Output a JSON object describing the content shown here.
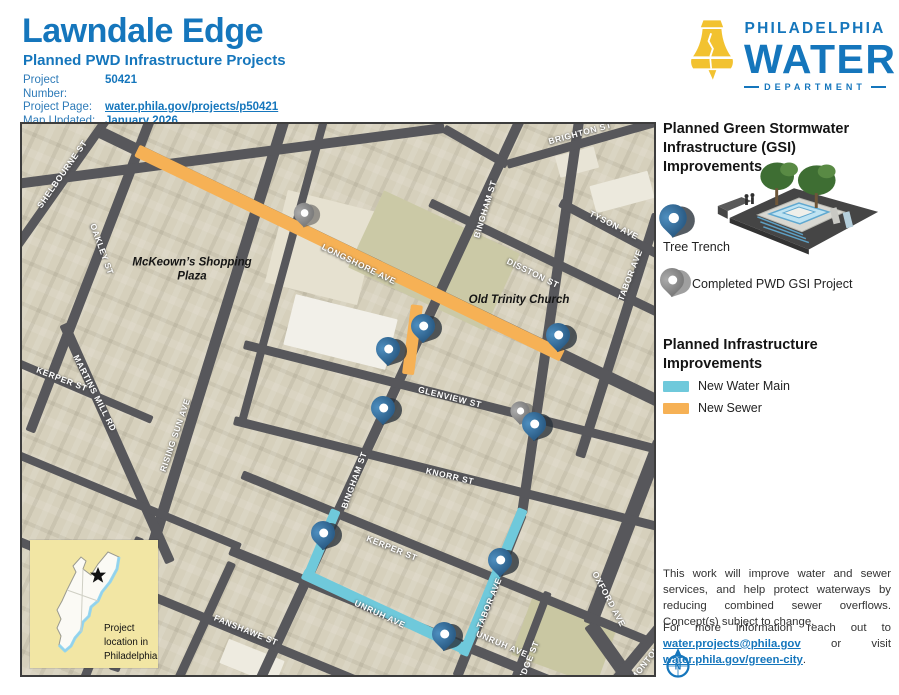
{
  "header": {
    "title": "Lawndale Edge",
    "subtitle": "Planned PWD Infrastructure Projects",
    "meta": [
      {
        "label": "Project Number:",
        "value": "50421"
      },
      {
        "label": "Project Page:",
        "value": "water.phila.gov/projects/p50421"
      },
      {
        "label": "Map Updated:",
        "value": "January 2026"
      }
    ]
  },
  "logo": {
    "line1": "PHILADELPHIA",
    "line2": "WATER",
    "line3": "DEPARTMENT"
  },
  "colors": {
    "brand_blue": "#1576BC",
    "bell_yellow": "#F2C230",
    "sewer_orange": "#F6B155",
    "water_cyan": "#6FC9DB",
    "road_gray": "#57575B",
    "pin_blue": "#2F6590",
    "pin_gray": "#8A8A8A",
    "inset_yellow": "#F2E6A4"
  },
  "map": {
    "roads": [
      {
        "x1": 88,
        "y1": -10,
        "x2": -8,
        "y2": 126,
        "w": 9,
        "name": "road-shelbourne-st"
      },
      {
        "x1": 128,
        "y1": -4,
        "x2": 8,
        "y2": 308,
        "w": 10,
        "name": "road-oakley-st"
      },
      {
        "x1": 262,
        "y1": -4,
        "x2": 92,
        "y2": 546,
        "w": 11,
        "name": "road-rising-sun-ave"
      },
      {
        "x1": 42,
        "y1": 200,
        "x2": 148,
        "y2": 438,
        "w": 10,
        "name": "road-martins-mill-rd"
      },
      {
        "x1": 302,
        "y1": -4,
        "x2": 220,
        "y2": 298,
        "w": 8,
        "name": "road-unnamed"
      },
      {
        "x1": 498,
        "y1": -4,
        "x2": 238,
        "y2": 556,
        "w": 10,
        "name": "road-bingham-st"
      },
      {
        "x1": 558,
        "y1": -10,
        "x2": 500,
        "y2": 390,
        "w": 10,
        "name": "road-tabor-upper"
      },
      {
        "x1": 500,
        "y1": 390,
        "x2": 435,
        "y2": 553,
        "w": 10,
        "name": "road-tabor-lower"
      },
      {
        "x1": 635,
        "y1": 90,
        "x2": 558,
        "y2": 333,
        "w": 10,
        "name": "road-tabor-ave"
      },
      {
        "x1": 638,
        "y1": 318,
        "x2": 568,
        "y2": 500,
        "w": 14,
        "name": "road-oxford-ave"
      },
      {
        "x1": 568,
        "y1": 500,
        "x2": 620,
        "y2": 573,
        "w": 14,
        "name": "road-oxford-ave"
      },
      {
        "x1": 580,
        "y1": 573,
        "x2": 640,
        "y2": 500,
        "w": 11,
        "name": "road-montour-st"
      },
      {
        "x1": 526,
        "y1": 468,
        "x2": 486,
        "y2": 573,
        "w": 8,
        "name": "road-ridge-st"
      },
      {
        "x1": 118,
        "y1": 413,
        "x2": 55,
        "y2": 573,
        "w": 9,
        "name": "road-unnamed"
      },
      {
        "x1": 210,
        "y1": 438,
        "x2": 148,
        "y2": 573,
        "w": 9,
        "name": "road-unnamed"
      },
      {
        "x1": -6,
        "y1": 60,
        "x2": 422,
        "y2": 4,
        "w": 10,
        "name": "road-unnamed"
      },
      {
        "x1": 422,
        "y1": 4,
        "x2": 485,
        "y2": 40,
        "w": 9,
        "name": "road-unnamed"
      },
      {
        "x1": 485,
        "y1": 40,
        "x2": 640,
        "y2": -4,
        "w": 9,
        "name": "road-brighton-st"
      },
      {
        "x1": 78,
        "y1": 8,
        "x2": 638,
        "y2": 278,
        "w": 12,
        "name": "road-longshore-ave"
      },
      {
        "x1": 538,
        "y1": 78,
        "x2": 640,
        "y2": 132,
        "w": 9,
        "name": "road-tyson-ave"
      },
      {
        "x1": 408,
        "y1": 78,
        "x2": 640,
        "y2": 190,
        "w": 9,
        "name": "road-disston-st"
      },
      {
        "x1": 222,
        "y1": 220,
        "x2": 640,
        "y2": 326,
        "w": 9,
        "name": "road-glenview-st"
      },
      {
        "x1": 212,
        "y1": 296,
        "x2": 640,
        "y2": 403,
        "w": 9,
        "name": "road-knorr-st"
      },
      {
        "x1": 220,
        "y1": 350,
        "x2": 625,
        "y2": 516,
        "w": 9,
        "name": "road-kerper-st"
      },
      {
        "x1": 208,
        "y1": 426,
        "x2": 580,
        "y2": 578,
        "w": 10,
        "name": "road-unruh-ave"
      },
      {
        "x1": -5,
        "y1": 416,
        "x2": 388,
        "y2": 578,
        "w": 9,
        "name": "road-fanshawe-st"
      },
      {
        "x1": -6,
        "y1": 330,
        "x2": 218,
        "y2": 423,
        "w": 8,
        "name": "road-unnamed"
      },
      {
        "x1": -6,
        "y1": 238,
        "x2": 130,
        "y2": 296,
        "w": 8,
        "name": "road-kerper-st-west"
      }
    ],
    "infra": [
      {
        "x1": 115,
        "y1": 26,
        "x2": 540,
        "y2": 231,
        "w": 13,
        "color": "sewer_orange",
        "name": "new-sewer-longshore"
      },
      {
        "x1": 395,
        "y1": 181,
        "x2": 386,
        "y2": 250,
        "w": 12,
        "color": "sewer_orange",
        "name": "new-sewer-stub"
      },
      {
        "x1": 314,
        "y1": 386,
        "x2": 285,
        "y2": 455,
        "w": 10,
        "color": "water_cyan",
        "name": "new-water-bingham"
      },
      {
        "x1": 281,
        "y1": 449,
        "x2": 444,
        "y2": 525,
        "w": 11,
        "color": "water_cyan",
        "name": "new-water-unruh"
      },
      {
        "x1": 501,
        "y1": 385,
        "x2": 441,
        "y2": 531,
        "w": 10,
        "color": "water_cyan",
        "name": "new-water-tabor"
      }
    ],
    "buildings": [
      {
        "x": 300,
        "y": 123,
        "w": 95,
        "h": 95,
        "rot": 14,
        "c": "#E6E1D0"
      },
      {
        "x": 318,
        "y": 208,
        "w": 105,
        "h": 52,
        "rot": 14,
        "c": "#F2F0E9"
      },
      {
        "x": 412,
        "y": 136,
        "w": 150,
        "h": 85,
        "rot": 25,
        "c": "#CBC9A6"
      },
      {
        "x": 542,
        "y": 518,
        "w": 90,
        "h": 60,
        "rot": 20,
        "c": "#C9C7A2"
      },
      {
        "x": 75,
        "y": 463,
        "w": 70,
        "h": 40,
        "rot": 22,
        "c": "#EFEDE4"
      },
      {
        "x": 600,
        "y": 68,
        "w": 60,
        "h": 28,
        "rot": -15,
        "c": "#ECE9DD"
      },
      {
        "x": 555,
        "y": 38,
        "w": 40,
        "h": 22,
        "rot": -15,
        "c": "#E8E4D6"
      },
      {
        "x": 230,
        "y": 538,
        "w": 60,
        "h": 26,
        "rot": 22,
        "c": "#EEEBE0"
      }
    ],
    "streets": [
      {
        "t": "SHELBOURNE ST",
        "x": 40,
        "y": 50,
        "r": -55
      },
      {
        "t": "OAKLEY ST",
        "x": 80,
        "y": 125,
        "r": 70
      },
      {
        "t": "BINGHAM ST",
        "x": 463,
        "y": 85,
        "r": -73
      },
      {
        "t": "BRIGHTON ST",
        "x": 558,
        "y": 9,
        "r": -15
      },
      {
        "t": "TYSON AVE",
        "x": 592,
        "y": 101,
        "r": 27
      },
      {
        "t": "DISSTON ST",
        "x": 511,
        "y": 149,
        "r": 26
      },
      {
        "t": "TABOR AVE",
        "x": 608,
        "y": 151,
        "r": -69
      },
      {
        "t": "LONGSHORE AVE",
        "x": 337,
        "y": 140,
        "r": 26
      },
      {
        "t": "GLENVIEW ST",
        "x": 428,
        "y": 273,
        "r": 14
      },
      {
        "t": "KNORR ST",
        "x": 428,
        "y": 352,
        "r": 13
      },
      {
        "t": "BINGHAM ST",
        "x": 332,
        "y": 356,
        "r": -70
      },
      {
        "t": "MARTINS MILL RD",
        "x": 73,
        "y": 269,
        "r": 63
      },
      {
        "t": "RISING SUN AVE",
        "x": 153,
        "y": 311,
        "r": -71
      },
      {
        "t": "KERPER ST",
        "x": 40,
        "y": 255,
        "r": 21
      },
      {
        "t": "KERPER ST",
        "x": 370,
        "y": 424,
        "r": 22
      },
      {
        "t": "UNRUH AVE",
        "x": 358,
        "y": 490,
        "r": 25
      },
      {
        "t": "TABOR AVE",
        "x": 467,
        "y": 479,
        "r": -68
      },
      {
        "t": "UNRUH AVE",
        "x": 480,
        "y": 520,
        "r": 23
      },
      {
        "t": "FANSHAWE ST",
        "x": 224,
        "y": 506,
        "r": 22
      },
      {
        "t": "OXFORD AVE",
        "x": 587,
        "y": 475,
        "r": 62
      },
      {
        "t": "RIDGE ST",
        "x": 506,
        "y": 538,
        "r": -68
      },
      {
        "t": "MONTOUR ST",
        "x": 630,
        "y": 530,
        "r": -52
      }
    ],
    "places": [
      {
        "t": "McKeown’s Shopping Plaza",
        "x": 170,
        "y": 146
      },
      {
        "t": "Old Trinity Church",
        "x": 497,
        "y": 176
      }
    ],
    "pins": [
      {
        "type": "gray",
        "x": 282,
        "y": 89,
        "s": 0.85
      },
      {
        "type": "gray",
        "x": 498,
        "y": 287,
        "s": 0.8
      },
      {
        "type": "blue",
        "x": 401,
        "y": 202,
        "s": 1
      },
      {
        "type": "blue",
        "x": 366,
        "y": 225,
        "s": 1
      },
      {
        "type": "blue",
        "x": 536,
        "y": 211,
        "s": 1
      },
      {
        "type": "blue",
        "x": 361,
        "y": 284,
        "s": 1
      },
      {
        "type": "blue",
        "x": 512,
        "y": 300,
        "s": 1
      },
      {
        "type": "blue",
        "x": 301,
        "y": 409,
        "s": 1
      },
      {
        "type": "blue",
        "x": 478,
        "y": 436,
        "s": 1
      },
      {
        "type": "blue",
        "x": 422,
        "y": 510,
        "s": 1
      }
    ]
  },
  "inset": {
    "caption": "Project location in Philadelphia"
  },
  "sidebar": {
    "gsi_heading": "Planned Green Stormwater Infrastructure (GSI) Improvements",
    "tree_trench_label": "Tree Trench",
    "completed_label": "Completed PWD GSI Project",
    "infra_heading": "Planned Infrastructure Improvements",
    "water_main_label": "New Water Main",
    "sewer_label": "New Sewer",
    "note1": "This work will improve water and sewer services, and help protect waterways by reducing combined sewer overflows. Concept(s) subject to change.",
    "note2": {
      "prefix": "For more information reach out to ",
      "link1": "water.projects@phila.gov",
      "middle": " or visit ",
      "link2": "water.phila.gov/green-city",
      "suffix": "."
    },
    "compass_letter": "N"
  }
}
